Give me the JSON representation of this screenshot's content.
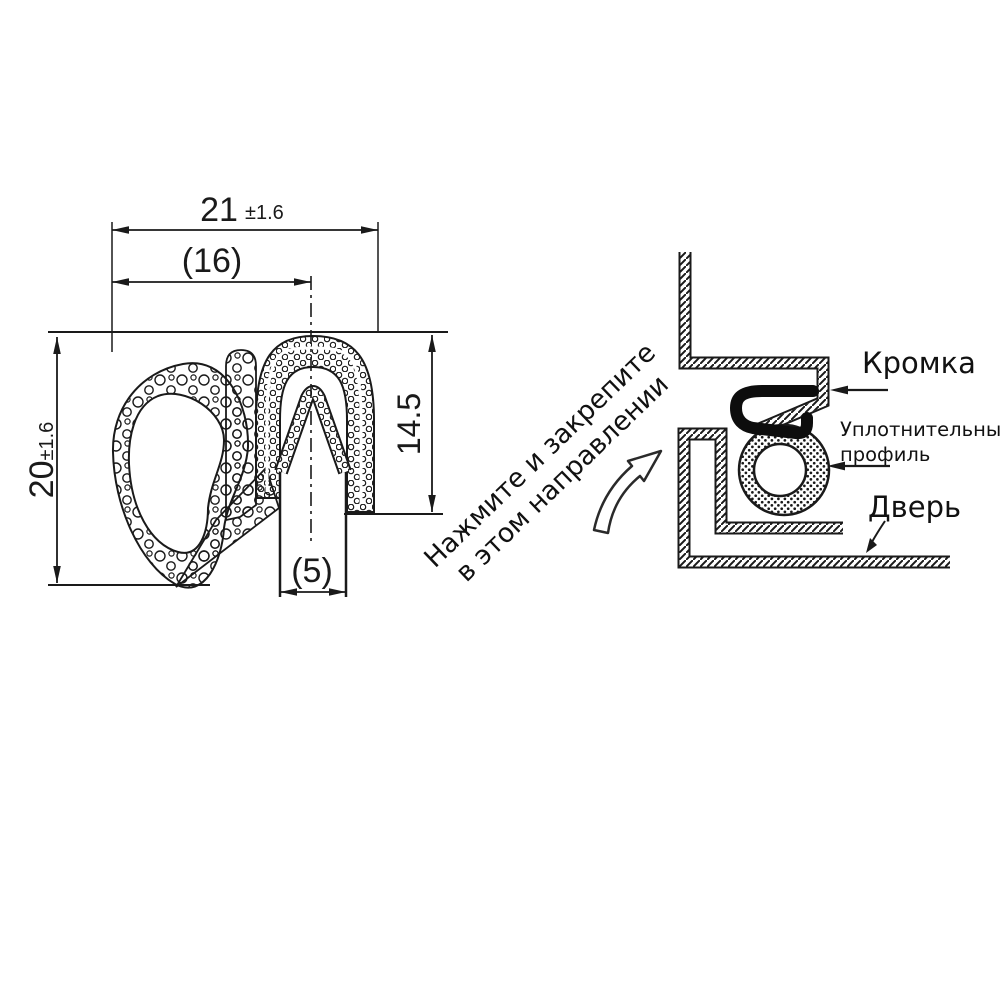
{
  "page": {
    "background": "#ffffff",
    "line_color": "#1a1a1a"
  },
  "cross_section": {
    "dim_width_total": {
      "value": "21",
      "tolerance": "±1.6"
    },
    "dim_width_ref": "(16)",
    "dim_height_total": {
      "value": "20",
      "tolerance": "±1.6"
    },
    "dim_height_u": "14.5",
    "dim_slot_ref": "(5)"
  },
  "installation": {
    "instruction_line1": "Нажмите и закрепите",
    "instruction_line2": "в этом направлении",
    "label_edge": "Кромка",
    "label_seal_line1": "Уплотнительный",
    "label_seal_line2": "профиль",
    "label_door": "Дверь"
  }
}
